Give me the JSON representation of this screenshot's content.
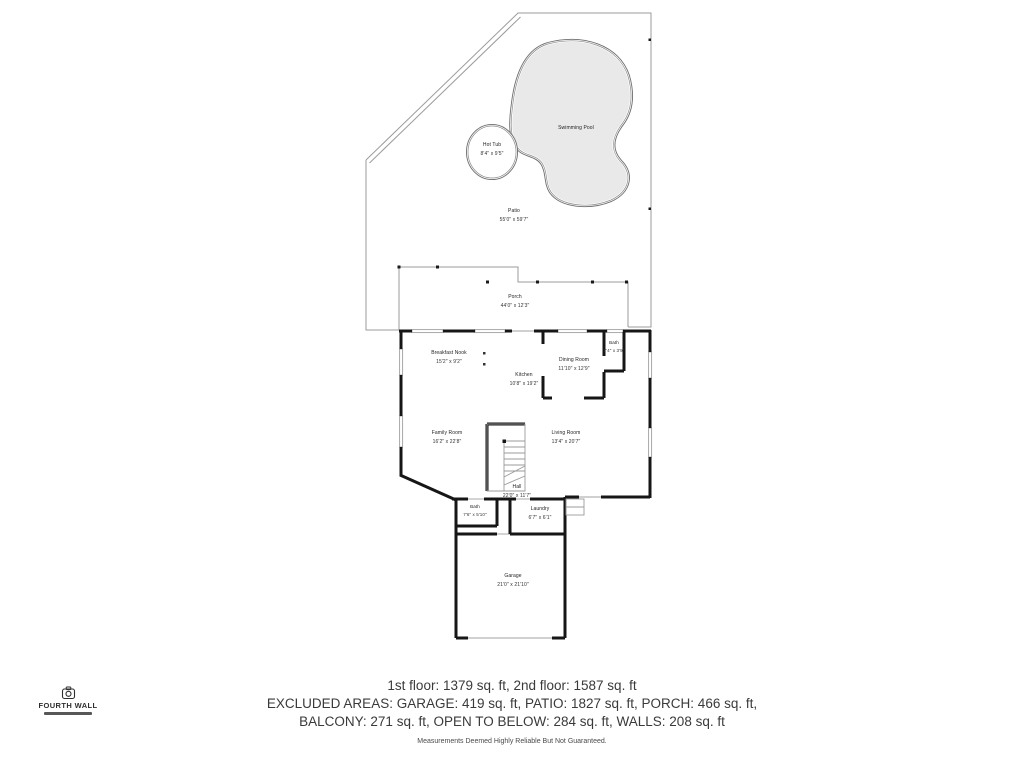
{
  "outdoor": {
    "swimming_pool": {
      "name": "Swimming Pool"
    },
    "hot_tub": {
      "name": "Hot Tub",
      "dims": "8'4\" x 9'5\""
    },
    "patio": {
      "name": "Patio",
      "dims": "55'0\" x 59'7\""
    },
    "porch": {
      "name": "Porch",
      "dims": "44'0\" x 12'3\""
    }
  },
  "rooms": [
    {
      "name": "Breakfast Nook",
      "dims": "15'2\" x 9'2\""
    },
    {
      "name": "Kitchen",
      "dims": "10'8\" x 19'2\""
    },
    {
      "name": "Dining Room",
      "dims": "11'10\" x 12'9\""
    },
    {
      "name": "Bath",
      "dims": "7'4\" x 3'9\""
    },
    {
      "name": "Family Room",
      "dims": "16'2\" x 22'8\""
    },
    {
      "name": "Living Room",
      "dims": "13'4\" x 20'7\""
    },
    {
      "name": "Hall",
      "dims": "22'0\" x 11'7\""
    },
    {
      "name": "Bath",
      "dims": "7'6\" x 5'10\""
    },
    {
      "name": "Laundry",
      "dims": "6'7\" x 6'1\""
    },
    {
      "name": "Garage",
      "dims": "21'0\" x 21'10\""
    }
  ],
  "footer": {
    "line1": "1st floor: 1379 sq. ft, 2nd floor: 1587 sq. ft",
    "line2": "EXCLUDED AREAS: GARAGE: 419 sq. ft, PATIO: 1827 sq. ft, PORCH: 466 sq. ft,",
    "line3": "BALCONY: 271 sq. ft, OPEN TO BELOW: 284 sq. ft, WALLS: 208 sq. ft",
    "disclaimer": "Measurements Deemed Highly Reliable But Not Guaranteed."
  },
  "logo": {
    "name": "FOURTH WALL"
  },
  "colors": {
    "background": "#ffffff",
    "wall": "#161616",
    "thin_outline": "#9b9b9b",
    "pool_fill": "#e9e9e9",
    "pool_edge": "#6e6e6e",
    "footer_text": "#3a3a3a",
    "label_text": "#222222"
  }
}
